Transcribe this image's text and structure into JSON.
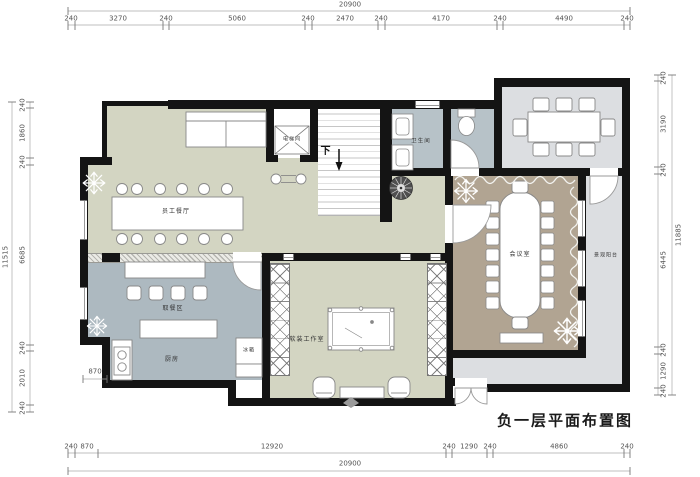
{
  "title": "负一层平面布置图",
  "rooms": {
    "staff_dining": "员工餐厅",
    "elevator": "电梯间",
    "stairs_down": "下",
    "bathroom": "卫生间",
    "meeting_room": "会议室",
    "balcony": "景观阳台",
    "serving_area": "取餐区",
    "kitchen": "厨房",
    "fridge": "冰箱",
    "studio": "软装工作室"
  },
  "dimensions": {
    "top_total": "20900",
    "top_segments": [
      "240",
      "3270",
      "240",
      "5060",
      "240",
      "2470",
      "240",
      "4170",
      "240",
      "4490",
      "240"
    ],
    "left_total": "11515",
    "left_segments": [
      "240",
      "1860",
      "240",
      "6685",
      "240",
      "2010",
      "240"
    ],
    "right_total": "11885",
    "right_segments": [
      "240",
      "3190",
      "240",
      "6445",
      "240",
      "1290",
      "240"
    ],
    "bottom_total": "20900",
    "bottom_segments": [
      "240",
      "870",
      "12920",
      "240",
      "1290",
      "240",
      "4860",
      "240"
    ],
    "kitchen_offset": "870"
  },
  "colors": {
    "wall": "#141414",
    "dining_floor": "#d3d5c2",
    "studio_floor": "#d3d5c2",
    "service_floor": "#adb9c0",
    "bath_floor": "#b7c2c8",
    "meeting_floor": "#b1a492",
    "balcony_floor": "#dcdee1"
  }
}
